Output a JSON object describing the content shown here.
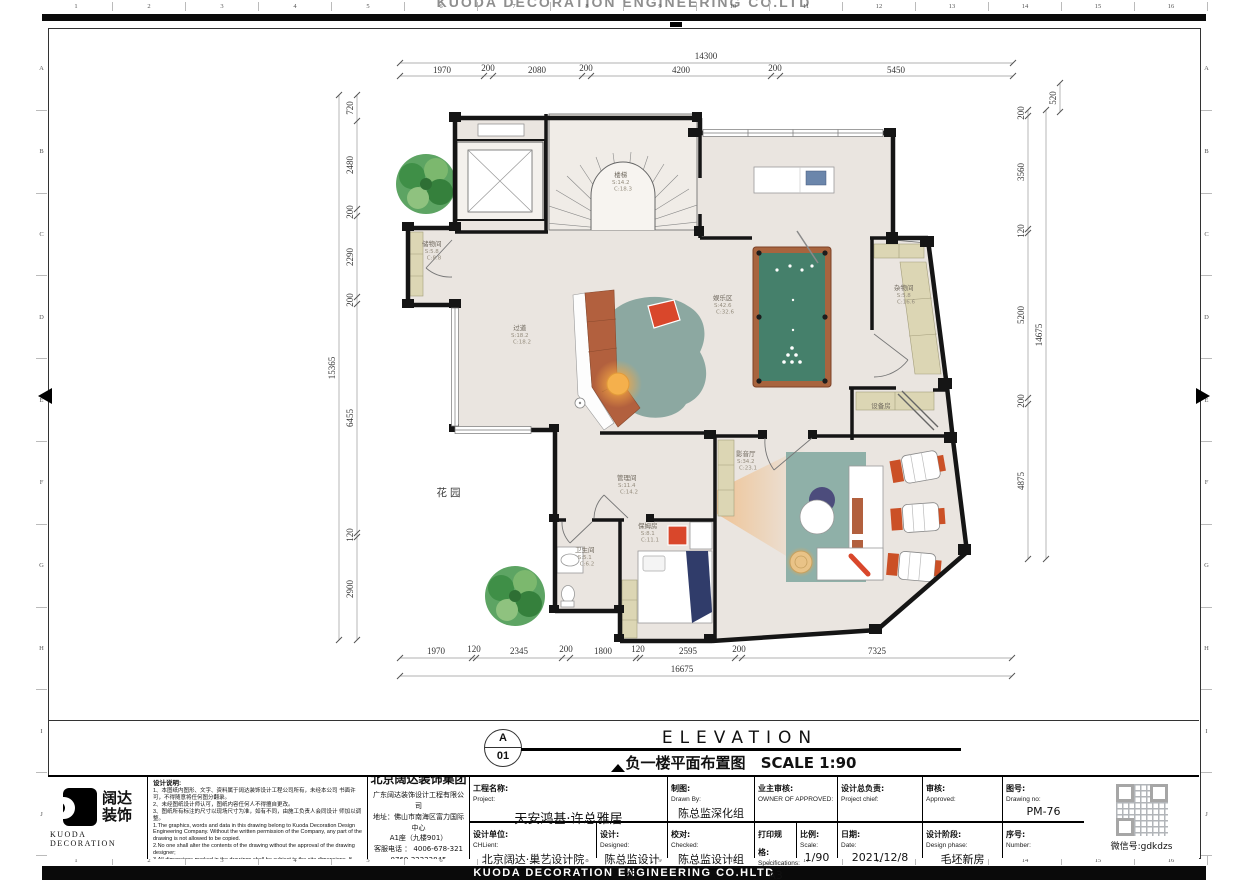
{
  "banner": {
    "top": "KUODA DECORATION ENGINEERING CO.LTD",
    "bottom": "KUODA DECORATION ENGINEERING  CO.HLTD"
  },
  "rulers": {
    "cols": [
      "1",
      "2",
      "3",
      "4",
      "5",
      "6",
      "7",
      "8",
      "9",
      "10",
      "11",
      "12",
      "13",
      "14",
      "15",
      "16"
    ],
    "rows": [
      "A",
      "B",
      "C",
      "D",
      "E",
      "F",
      "G",
      "H",
      "I",
      "J"
    ]
  },
  "drawing_title": {
    "detail_letter": "A",
    "detail_number": "01",
    "title_en": "ELEVATION",
    "title_cn": "负一楼平面布置图",
    "scale_label": "SCALE 1:90"
  },
  "plan": {
    "garden": "花园",
    "rooms": {
      "stair": {
        "name": "楼梯",
        "s": "S:14.2",
        "c": "C:18.3"
      },
      "corridor": {
        "name": "过道",
        "s": "S:18.2",
        "c": "C:18.2"
      },
      "storage": {
        "name": "储物间",
        "s": "S:5.8",
        "c": "C:8.8"
      },
      "entertainment": {
        "name": "娱乐区",
        "s": "S:42.6",
        "c": "C:32.6"
      },
      "sundry": {
        "name": "杂物间",
        "s": "S:5.8",
        "c": "C:16.6"
      },
      "equipment": {
        "name": "设备房",
        "s": "",
        "c": ""
      },
      "theater": {
        "name": "影音厅",
        "s": "S:34.2",
        "c": "C:23.1"
      },
      "management": {
        "name": "管理间",
        "s": "S:11.4",
        "c": "C:14.2"
      },
      "nanny": {
        "name": "保姆房",
        "s": "S:8.1",
        "c": "C:11.1"
      },
      "bath": {
        "name": "卫生间",
        "s": "S:5.1",
        "c": "C:6.2"
      }
    },
    "dims": {
      "top_total": "14300",
      "top_chain": [
        "1970",
        "200",
        "2080",
        "200",
        "4200",
        "200",
        "5450"
      ],
      "bottom_chain": [
        "1970",
        "120",
        "2345",
        "200",
        "1800",
        "120",
        "2595",
        "200",
        "7325"
      ],
      "bottom_total": "16675",
      "left_chain": [
        "720",
        "2480",
        "200",
        "2290",
        "200",
        "6455",
        "120",
        "2900"
      ],
      "left_total": "15365",
      "right_chain": [
        "200",
        "3560",
        "120",
        "5200",
        "200",
        "4875"
      ],
      "right_total": "14675",
      "right_top": "520"
    }
  },
  "title_block": {
    "logo": {
      "cn1": "阔达",
      "cn2": "装饰",
      "en": "KUODA  DECORATION"
    },
    "notes": {
      "title": "设计说明:",
      "cn1": "1、本图纸内图形、文字、资料属于阔达装饰设计工程公司所有，未经本公司 书面许可，不得随意将任何图分翻录。",
      "cn2": "2、未经图纸设计师认可，图纸内容任何人不得擅自更改。",
      "cn3": "3、图纸所有标注的尺寸以现场尺寸为准，如有不同，由施工负责人会同设计 师加以调整。",
      "en1": "1.The graphics, words and data in this drawing belong to Kuoda Decoration Design Engineering Company. Without the written permission of the Company, any part of the drawing is not allowed to be copied.",
      "en2": "2.No one shall alter the contents of the drawing without the approval of the drawing designer;",
      "en3": "3.All dimensions marked in the drawings shall be subject to the site dimensions. If there is any discrepancy, the construction leader shall make adjustments together with the designer."
    },
    "company": {
      "group": "北京阔达装饰集团",
      "sub": "广东阔达装饰设计工程有限公司",
      "addr1": "地址：佛山市南海区富力国际中心",
      "addr2": "A1座（九楼901）",
      "tel1": "客服电话 ： 4006-678-321",
      "tel2": "0769-22222845"
    },
    "fields": {
      "project": {
        "label_cn": "工程名称:",
        "label_en": "Project:",
        "value": "天安鸿基·许总雅居"
      },
      "drawn": {
        "label_cn": "制图:",
        "label_en": "Drawn By:",
        "value": "陈总监深化组"
      },
      "owner": {
        "label_cn": "业主审核:",
        "label_en": "OWNER OF APPROVED:",
        "value": ""
      },
      "chief": {
        "label_cn": "设计总负责:",
        "label_en": "Project chief:",
        "value": ""
      },
      "approved": {
        "label_cn": "审核:",
        "label_en": "Approved:",
        "value": ""
      },
      "drawing_no": {
        "label_cn": "图号:",
        "label_en": "Drawing no:",
        "value": "PM-76"
      },
      "design_unit": {
        "label_cn": "设计单位:",
        "label_en": "CHLient:",
        "value": "北京阔达·巢艺设计院"
      },
      "designed": {
        "label_cn": "设计:",
        "label_en": "Designed:",
        "value": "陈总监设计组"
      },
      "checked": {
        "label_cn": "校对:",
        "label_en": "Checked:",
        "value": "陈总监设计组"
      },
      "spec": {
        "label_cn": "打印规格:",
        "label_en": "Specifications:",
        "value": "A3"
      },
      "scale": {
        "label_cn": "比例:",
        "label_en": "Scale:",
        "value": "1/90"
      },
      "date": {
        "label_cn": "日期:",
        "label_en": "Date:",
        "value": "2021/12/8"
      },
      "phase": {
        "label_cn": "设计阶段:",
        "label_en": "Design phase:",
        "value": "毛坯新房"
      },
      "number": {
        "label_cn": "序号:",
        "label_en": "Number:",
        "value": ""
      }
    },
    "wechat": "微信号:gdkdzs"
  }
}
